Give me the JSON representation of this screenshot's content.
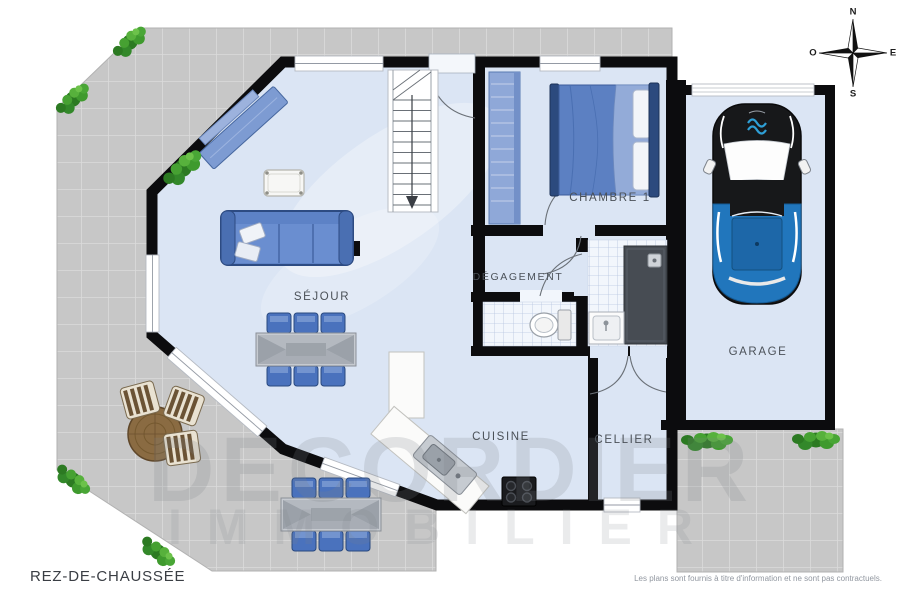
{
  "title": "REZ-DE-CHAUSSÉE",
  "disclaimer": "Les plans sont fournis à titre d'information et ne sont pas contractuels.",
  "rooms": {
    "sejour": "SÉJOUR",
    "chambre1": "CHAMBRE 1",
    "degagement": "DÉGAGEMENT",
    "cuisine": "CUISINE",
    "cellier": "CELLIER",
    "garage": "GARAGE"
  },
  "compass": {
    "north": "N",
    "south": "S",
    "east": "E",
    "west": "O"
  },
  "watermark": {
    "line1": "DECORDIER",
    "line2": "IMMOBILIER"
  },
  "colors": {
    "wall": "#0c0c0e",
    "floor": "#dbe5f4",
    "terrace": "#c7c7c7",
    "furniture_blue": "#5d82c6",
    "car_blue": "#2176bc",
    "plant_green": "#3f9a2e",
    "shower_gray": "#474c53"
  }
}
